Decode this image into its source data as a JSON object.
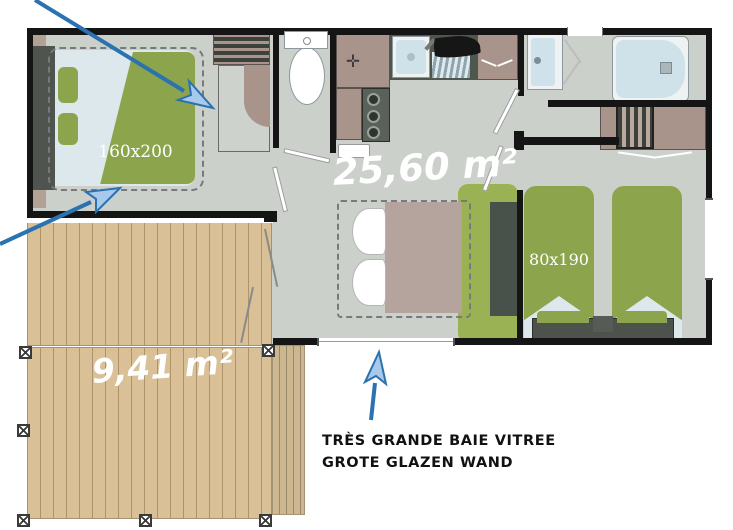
{
  "labels": {
    "living_area": "25,60 m²",
    "terrace": "9,41 m²",
    "master_bed": "160x200",
    "twin_beds": "80x190"
  },
  "caption": {
    "french": "TRÈS GRANDE BAIE VITREE",
    "dutch": "GROTE GLAZEN WAND"
  },
  "colors": {
    "wall": "#151515",
    "floor": "#ccd0cb",
    "deck_wood": "#d9c096",
    "bed_green": "#8ca44c",
    "sofa_green": "#9bb254",
    "cabinet_mauve": "#a9948c",
    "fixture_blue": "#cfe2ea",
    "arrow_stroke": "#2a72b0",
    "arrow_fill": "#a8c8ec",
    "label_text": "#ffffff",
    "caption_text": "#111111"
  }
}
